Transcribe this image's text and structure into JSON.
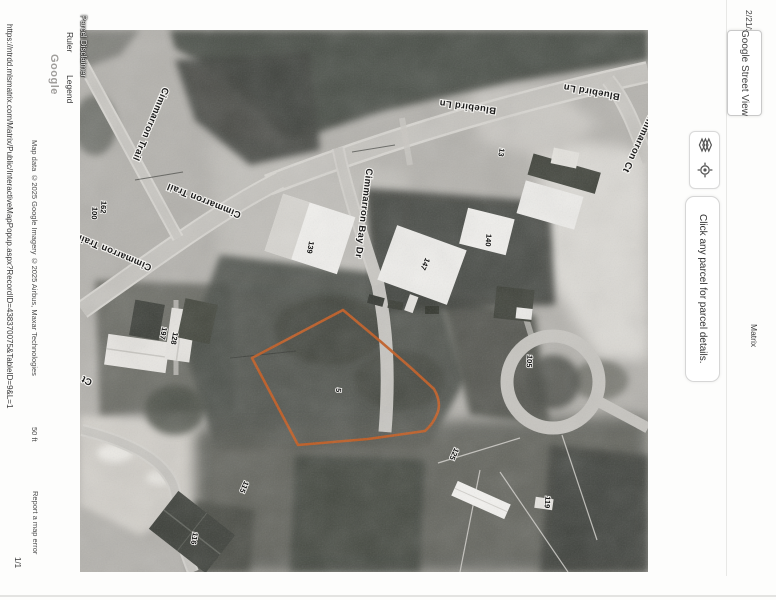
{
  "page": {
    "header_datetime": "2/21/25, 3:49 PM",
    "header_title": "Matrix",
    "footer_url": "https://ntrdd.mlsmatrix.com/Matrix/Public/InteractiveMapPopup.aspx?RecordID=438370075&TableID=9&L=1",
    "footer_page_number": "1/1"
  },
  "sidebar": {
    "street_view_button_label": "Google Street View",
    "instruction_text": "Click any parcel for parcel details.",
    "tool_icons": [
      "layers-icon",
      "my-location-icon"
    ]
  },
  "left_rail": {
    "parcel_disclaimer_label": "Parcel Disclaimer",
    "ruler_label": "Ruler",
    "legend_label": "Legend",
    "google_watermark": "Google"
  },
  "map": {
    "attribution": "Map data ©2025 Google Imagery ©2025 Airbus, Maxar Technologies",
    "scale_label": "50 ft",
    "report_error_label": "Report a map error",
    "parcel_outline_color": "#c35a1d",
    "street_labels": [
      {
        "text": "Bluebird Ln",
        "x": 388,
        "y": 74,
        "rot": 188
      },
      {
        "text": "Bluebird Ln",
        "x": 512,
        "y": 59,
        "rot": 190
      },
      {
        "text": "Cimmarron Trail",
        "x": 68,
        "y": 93,
        "rot": 113
      },
      {
        "text": "Cimmarron Trail",
        "x": 125,
        "y": 168,
        "rot": 202
      },
      {
        "text": "Cimmarron Trail",
        "x": 36,
        "y": 220,
        "rot": 203
      },
      {
        "text": "Cimmarron Bay Dr",
        "x": 281,
        "y": 183,
        "rot": 97
      },
      {
        "text": "Cimmarron Ct",
        "x": 557,
        "y": 110,
        "rot": 115
      },
      {
        "text": "Ct",
        "x": 8,
        "y": 348,
        "rot": 205
      }
    ],
    "house_numbers": [
      {
        "text": "162",
        "x": 21,
        "y": 177,
        "rot": 95
      },
      {
        "text": "100",
        "x": 12,
        "y": 183,
        "rot": 95
      },
      {
        "text": "13",
        "x": 419,
        "y": 122,
        "rot": 100
      },
      {
        "text": "139",
        "x": 228,
        "y": 217,
        "rot": 100
      },
      {
        "text": "147",
        "x": 343,
        "y": 233,
        "rot": 115
      },
      {
        "text": "140",
        "x": 406,
        "y": 210,
        "rot": 95
      },
      {
        "text": "197",
        "x": 81,
        "y": 303,
        "rot": 100
      },
      {
        "text": "128",
        "x": 92,
        "y": 308,
        "rot": 100
      },
      {
        "text": "5",
        "x": 256,
        "y": 360,
        "rot": 95
      },
      {
        "text": "105",
        "x": 447,
        "y": 331,
        "rot": 95
      },
      {
        "text": "125",
        "x": 372,
        "y": 423,
        "rot": 115
      },
      {
        "text": "115",
        "x": 162,
        "y": 456,
        "rot": 115
      },
      {
        "text": "116",
        "x": 112,
        "y": 508,
        "rot": 100
      },
      {
        "text": "119",
        "x": 465,
        "y": 472,
        "rot": 95
      }
    ]
  }
}
